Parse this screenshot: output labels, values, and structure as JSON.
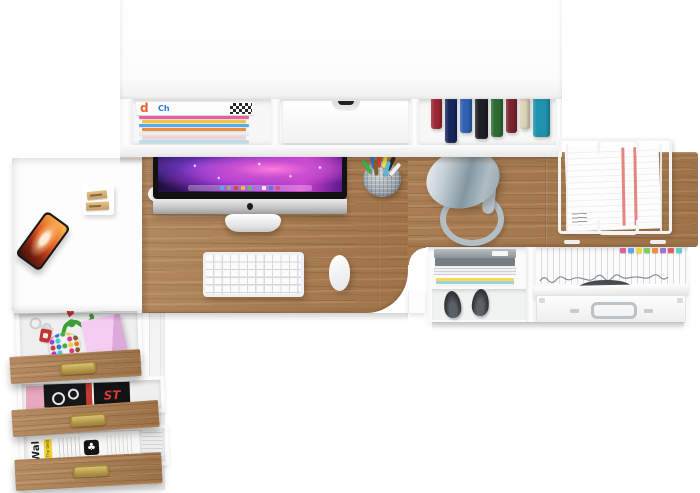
{
  "meta": {
    "canvas_width": 700,
    "canvas_height": 493
  },
  "palette": {
    "background": "#ffffff",
    "wood": "#ab7b4d",
    "furniture_white": "#fcfcfc",
    "lamp_metal": "#a9bac3",
    "brass_handle": "#aa8c3b",
    "paper_stripe_red": "#e0635e",
    "pink_box": "#f6cdf2"
  },
  "texts": {
    "magazine_letter_d": "d",
    "magazine_letter_ch": "Ch",
    "drawer_magazine_title": "ST",
    "newspaper_masthead": "Wal",
    "newspaper_tag": "The best",
    "newspaper_logo": "♣",
    "drawer_heart": "♥"
  },
  "hutch": {
    "magazine_spines": [
      "#e8609c",
      "#f2c33c",
      "#5aa8ee",
      "#ee8a3c",
      "#ececec",
      "#f0d2d8",
      "#bcdcec"
    ],
    "books": [
      {
        "color": "#9c2731",
        "width": 11,
        "height": 30
      },
      {
        "color": "#17265c",
        "width": 12,
        "height": 44
      },
      {
        "color": "#2f62b4",
        "width": 12,
        "height": 34
      },
      {
        "color": "#1e2025",
        "width": 13,
        "height": 40
      },
      {
        "color": "#2e6b33",
        "width": 12,
        "height": 38
      },
      {
        "color": "#7c2430",
        "width": 11,
        "height": 34
      },
      {
        "color": "#ddd3b8",
        "width": 10,
        "height": 30
      },
      {
        "color": "#1f93ad",
        "width": 17,
        "height": 38
      }
    ]
  },
  "imac": {
    "dock_icons": [
      "#5aa8f0",
      "#9aa0a8",
      "#d04a40",
      "#f0b84c",
      "#58c468",
      "#b070d8",
      "#ececec",
      "#4a80d0",
      "#e05070"
    ]
  },
  "desk_items": {
    "pen_colors": [
      "#3fae4a",
      "#2f6fd0",
      "#d23c30",
      "#e8e13a",
      "#232323",
      "#f0f0f0",
      "#8a5a2a",
      "#58b8d8"
    ]
  },
  "shelf_unit": {
    "file_tab_colors": [
      "#e85aa0",
      "#57a8f0",
      "#f2d43c",
      "#7ccf5a",
      "#f08a3c",
      "#a070e0",
      "#e85a5a",
      "#57d0c8"
    ],
    "magazine_pile": [
      "#fdfdfd",
      "#ffd84d",
      "#9fd4e8",
      "#f4f4f4"
    ]
  },
  "drawers": {
    "candy_colors": [
      "#d53a3a",
      "#3a6fd5",
      "#3fae4a",
      "#e8d23a",
      "#e87a2a",
      "#b03ad5",
      "#3ad5c8",
      "#f6f6f6",
      "#d53a8c",
      "#8a5a2a",
      "#d53a3a",
      "#3a6fd5",
      "#3fae4a",
      "#e8d23a",
      "#e87a2a",
      "#b03ad5",
      "#3ad5c8",
      "#f6f6f6",
      "#d53a8c",
      "#8a5a2a",
      "#e87a2a",
      "#3fae4a",
      "#3a6fd5",
      "#d53a8c"
    ]
  }
}
